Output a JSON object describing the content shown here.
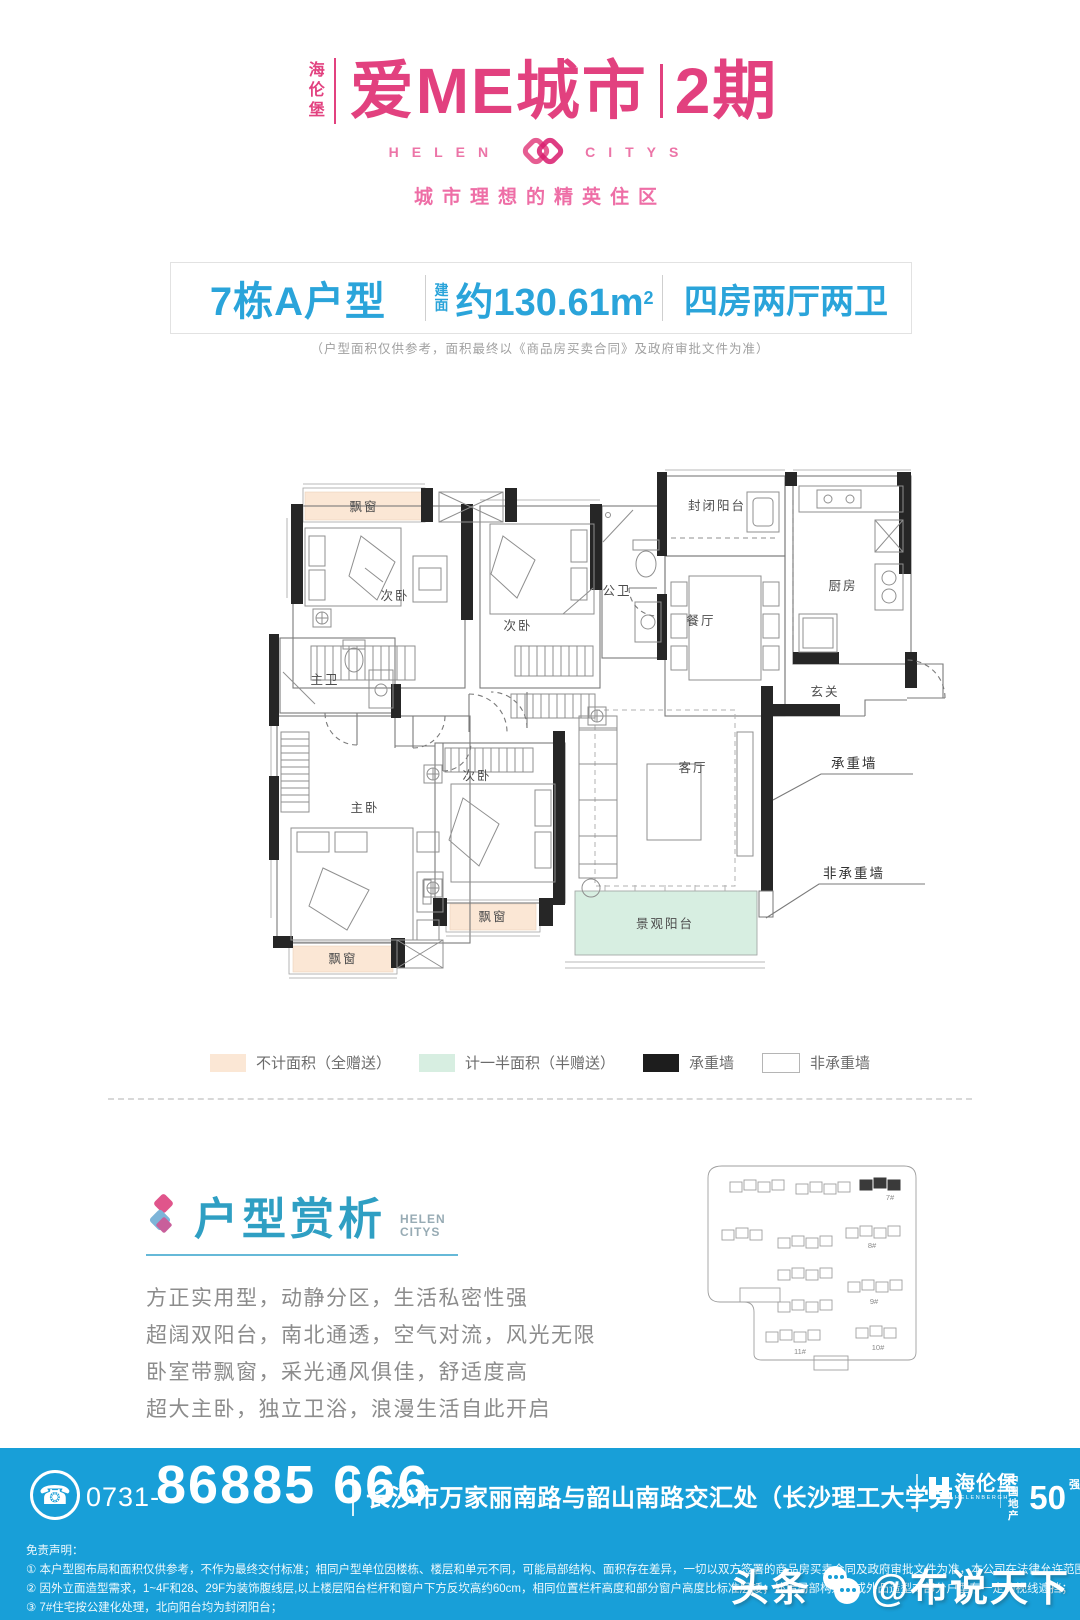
{
  "header": {
    "brand_vertical": "海伦堡",
    "title": "爱ME城市",
    "phase": "2期",
    "latin_left": "HELEN",
    "latin_right": "CITYS",
    "tagline": "城市理想的精英住区"
  },
  "info_bar": {
    "unit": "7栋A户型",
    "area_label": "建面",
    "area_value": "约130.61m",
    "area_sup": "2",
    "rooms": "四房两厅两卫",
    "note": "（户型面积仅供参考，面积最终以《商品房买卖合同》及政府审批文件为准）"
  },
  "floor_plan": {
    "bay_window_top": "飘窗",
    "bedroom_2": "次卧",
    "bedroom_3": "次卧",
    "public_bath": "公卫",
    "closed_balcony": "封闭阳台",
    "dining": "餐厅",
    "kitchen": "厨房",
    "foyer": "玄关",
    "master_bath": "主卫",
    "master_bedroom": "主卧",
    "bedroom_4": "次卧",
    "living": "客厅",
    "bay_window_mid": "飘窗",
    "bay_window_bottom": "飘窗",
    "view_balcony": "景观阳台",
    "ann_load_wall": "承重墙",
    "ann_non_load_wall": "非承重墙"
  },
  "legend": {
    "items": [
      {
        "label": "不计面积（全赠送）",
        "color": "#fbe7d5"
      },
      {
        "label": "计一半面积（半赠送）",
        "color": "#d7eee1"
      },
      {
        "label": "承重墙",
        "color": "#1d1d1d"
      },
      {
        "label": "非承重墙",
        "color": "#ffffff"
      }
    ]
  },
  "analysis": {
    "title": "户型赏析",
    "latin_1": "HELEN",
    "latin_2": "CITYS",
    "lines": [
      "方正实用型，动静分区，生活私密性强",
      "超阔双阳台，南北通透，空气对流，风光无限",
      "卧室带飘窗，采光通风俱佳，舒适度高",
      "超大主卧，独立卫浴，浪漫生活自此开启"
    ]
  },
  "siteplan": {
    "labels": [
      "7#",
      "8#",
      "9#",
      "10#",
      "11#"
    ]
  },
  "footer": {
    "area_code": "0731-",
    "phone": "86885 666",
    "address": "长沙市万家丽南路与韶山南路交汇处（长沙理工大学旁）",
    "brand": "海伦堡",
    "brand_latin": "HELENBERGH",
    "rank_cn_1": "中国",
    "rank_cn_2": "地产",
    "rank_num": "50",
    "rank_suffix": "强",
    "disclaimer_title": "免责声明：",
    "disclaimer_lines": [
      "① 本户型图布局和面积仅供参考，不作为最终交付标准；相同户型单位因楼栋、楼层和单元不同，可能局部结构、面积存在差异，一切以双方签署的商品房买卖合同及政府审批文件为准，本公司在法律允许范围内保留宣传资料的修改权和最终解释权！",
      "② 因外立面造型需求，1~4F和28、29F为装饰腹线层,以上楼层阳台栏杆和窗户下方反坎高约60cm，相同位置栏杆高度和部分窗户高度比标准层矮；外墙局部构造柱或外凸造型对部分户型存一定的视线遮挡；",
      "③ 7#住宅按公建化处理，北向阳台均为封闭阳台；"
    ]
  },
  "watermark": {
    "part1": "头条",
    "part2": "@布说天下"
  },
  "colors": {
    "brand_pink": "#e2417f",
    "accent_blue": "#2aa4da",
    "bar_blue": "#189fd8",
    "analysis_teal": "#2f9fc3",
    "bay_peach": "#fbe7d5",
    "balcony_green": "#d7eee1",
    "wall_black": "#262626"
  }
}
